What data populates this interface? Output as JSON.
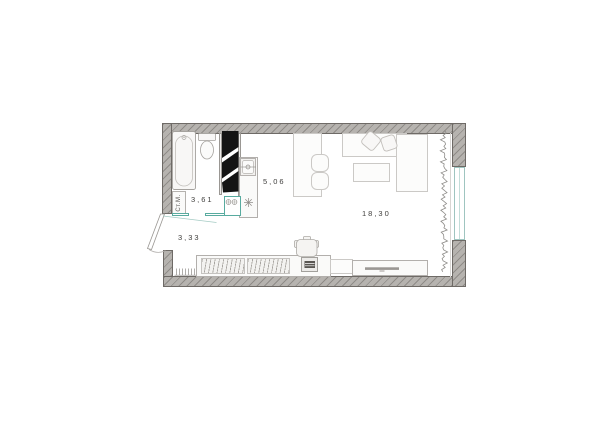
{
  "plan": {
    "rooms": [
      {
        "id": "bathroom",
        "area_label": "3,61"
      },
      {
        "id": "kitchen",
        "area_label": "5,06"
      },
      {
        "id": "hallway",
        "area_label": "3,33"
      },
      {
        "id": "living-room",
        "area_label": "18,30"
      }
    ],
    "appliance_labels": {
      "washing_machine": "Ст.М."
    },
    "colors": {
      "wall_fill": "#b6b3af",
      "wall_hatch": "#68645f",
      "wall_border": "#6e6a66",
      "door_window_accent": "#58ab9f",
      "window_glass": "#9fc5c0",
      "furniture_border": "#b2afac",
      "wardrobe_fill": "#141414",
      "label_text": "#3f3e3c"
    }
  }
}
